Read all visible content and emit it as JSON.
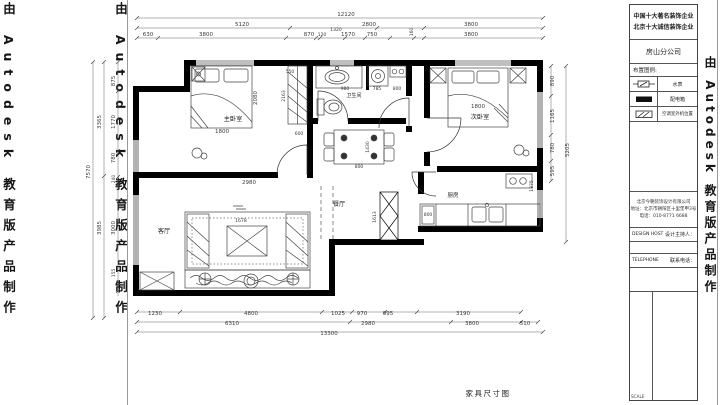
{
  "watermark": {
    "text": "由 Autodesk 教育版产品制作"
  },
  "sheet": {
    "drawing_title": "家具尺寸图"
  },
  "title_block": {
    "cert_line1": "中国十大著名装饰企业",
    "cert_line2": "北京十大诚信装饰企业",
    "branch": "房山分公司",
    "legend_title": "布置图例:",
    "legend": [
      {
        "symbol": "water-meter",
        "label": "水表"
      },
      {
        "symbol": "distribution-box",
        "label": "配电箱"
      },
      {
        "symbol": "ac-outdoor-unit",
        "label": "空调室外机位置"
      }
    ],
    "company_lines": [
      "北京今朝装饰设计有限公司",
      "地址：北京市朝阳区十里堡甲3号",
      "电话：010-8771 6688"
    ],
    "fields": [
      {
        "en": "DESIGN HOST",
        "zh": "设计主持人："
      },
      {
        "en": "TELEPHONE",
        "zh": "联系电话："
      }
    ],
    "scale_label": "SCALE"
  },
  "rooms": {
    "master_bedroom": "主卧室",
    "second_bedroom": "次卧室",
    "bathroom": "卫生间",
    "dining": "餐厅",
    "kitchen": "厨房",
    "living": "客厅"
  },
  "dims": {
    "top_total": "12120",
    "top_mid": [
      "5120",
      "2800",
      "3800"
    ],
    "top_inner": [
      "630",
      "3800",
      "870",
      "120",
      "1320",
      "1570",
      "750",
      "160",
      "3800"
    ],
    "bottom_inner": [
      "1230",
      "4800",
      "1025",
      "970",
      "995",
      "3190"
    ],
    "bottom_mid": [
      "6310",
      "2980",
      "3800",
      "510"
    ],
    "bottom_total": "13300",
    "left_total": "7570",
    "left_mid": [
      "3365",
      "3985"
    ],
    "left_inner": [
      "875",
      "1770",
      "780",
      "240",
      "3000",
      "155"
    ],
    "right_inner": [
      "890",
      "1165",
      "780",
      "595"
    ],
    "right_total": "5205",
    "interior": {
      "bed1_width": "1800",
      "bed1_length": "2080",
      "room1_width": "2980",
      "wardrobe_length": "2163",
      "wardrobe_depth": "600",
      "closet_width": "550",
      "basin": "980",
      "washer": "785",
      "bath_right": "800",
      "table_width": "800",
      "table_length": "1430",
      "shaft_height": "1613",
      "counter": "800",
      "kitchen_depth": "1375",
      "tv_width": "1678",
      "bed2_width": "1800"
    }
  }
}
